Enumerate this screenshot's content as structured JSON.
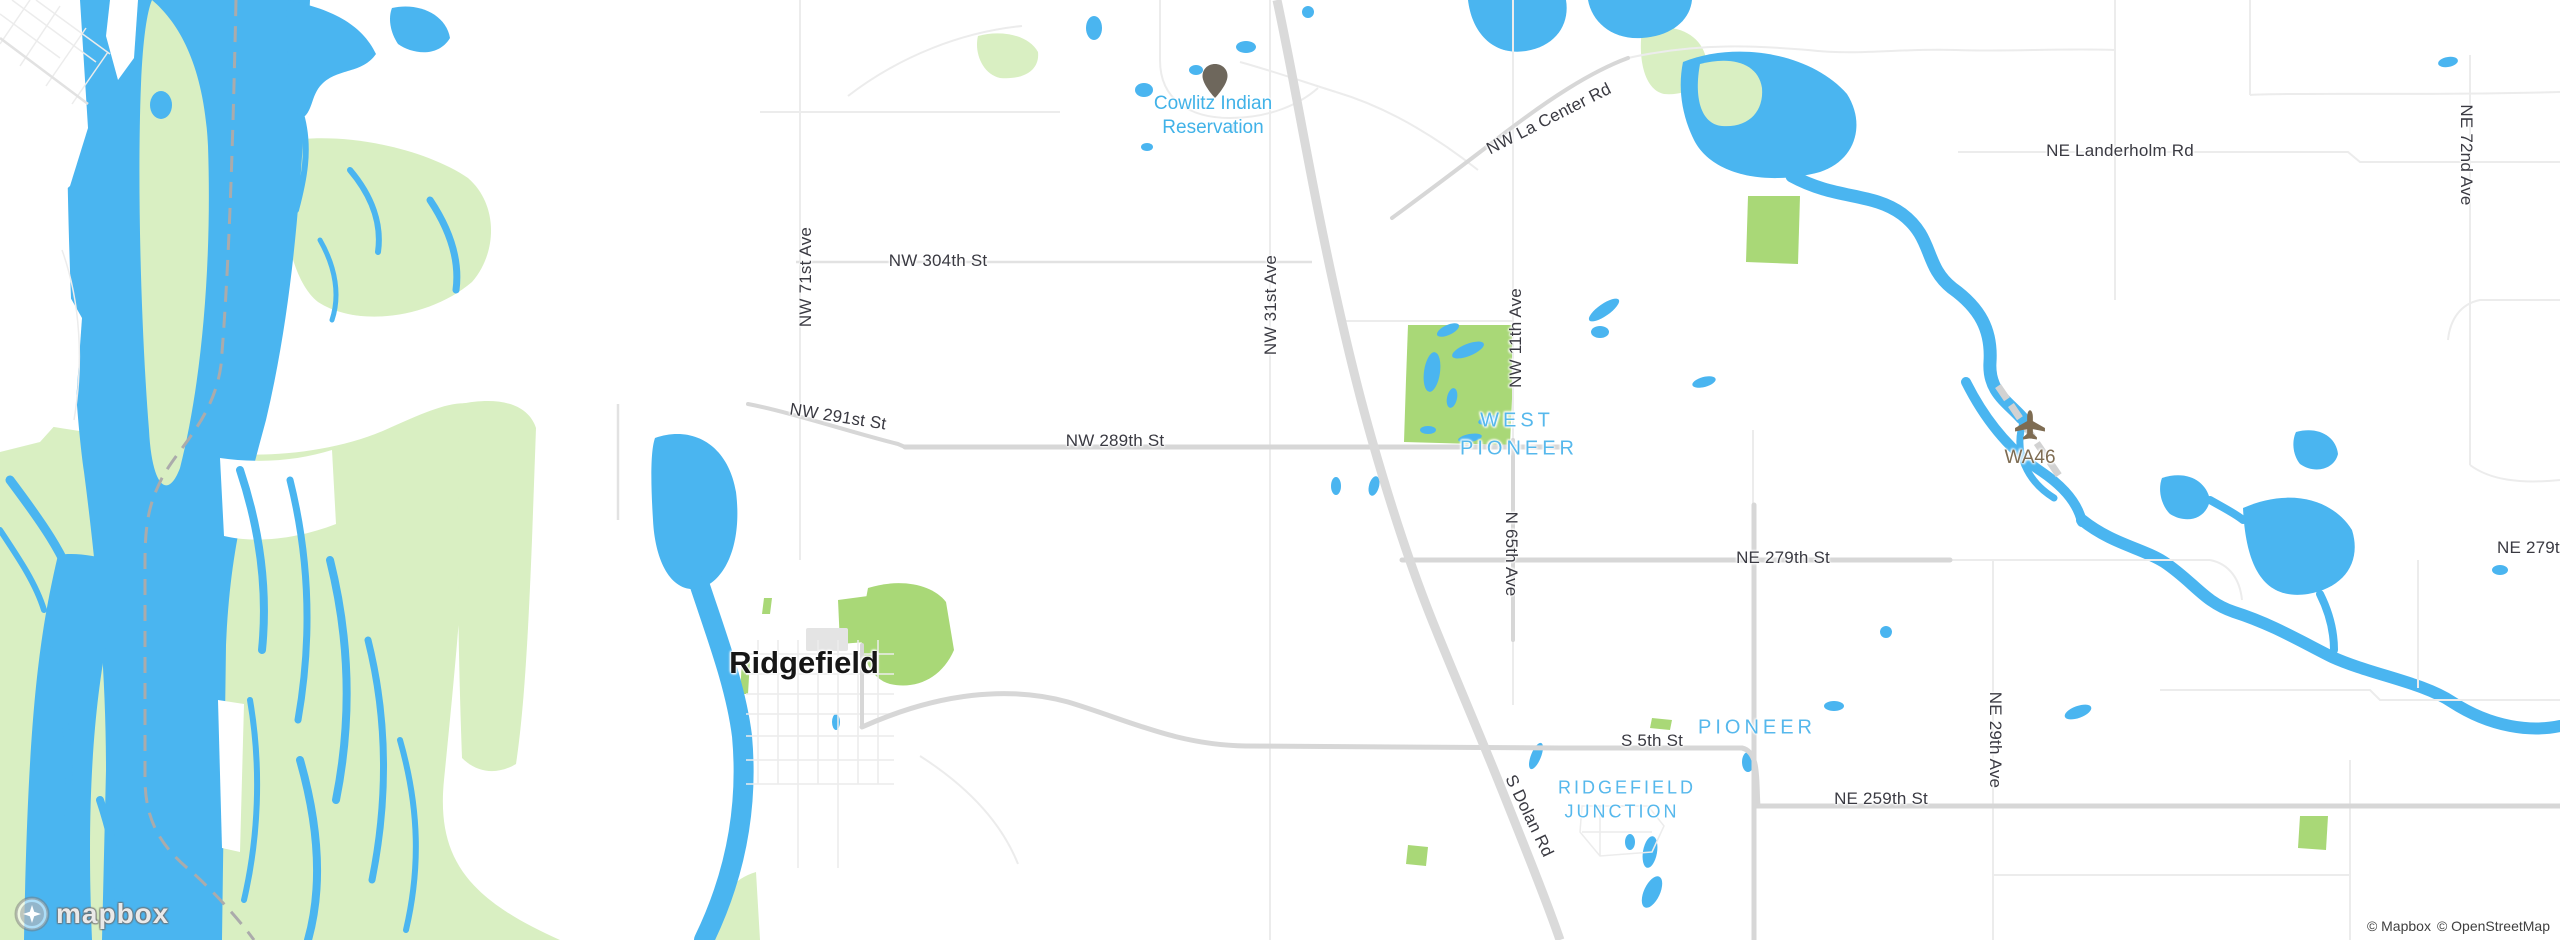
{
  "map": {
    "city_label": "Ridgefield",
    "reservation": {
      "line1": "Cowlitz Indian",
      "line2": "Reservation"
    },
    "neighborhoods": {
      "west_pioneer_line1": "WEST",
      "west_pioneer_line2": "PIONEER",
      "pioneer": "PIONEER",
      "junction_line1": "RIDGEFIELD",
      "junction_line2": "JUNCTION"
    },
    "airport_code": "WA46",
    "roads": {
      "nw_la_center_rd": "NW La Center Rd",
      "ne_landerholm_rd": "NE Landerholm Rd",
      "ne_72nd_ave": "NE 72nd Ave",
      "nw_71st_ave": "NW 71st Ave",
      "nw_304th_st": "NW 304th St",
      "nw_31st_ave": "NW 31st Ave",
      "nw_11th_ave": "NW 11th Ave",
      "nw_291st_st": "NW 291st St",
      "nw_289th_st": "NW 289th St",
      "ne_279th_st": "NE 279th St",
      "ne_279th_st_east": "NE 279th St",
      "n_65th_ave": "N 65th Ave",
      "s_5th_st": "S 5th St",
      "s_dolan_rd": "S Dolan Rd",
      "ne_259th_st": "NE 259th St",
      "ne_29th_ave": "NE 29th Ave"
    }
  },
  "branding": {
    "logo_text": "mapbox",
    "attribution_mapbox": "© Mapbox",
    "attribution_osm": "© OpenStreetMap"
  },
  "colors": {
    "land": "#ffffff",
    "water": "#4ab5f0",
    "wetland": "#d9efc2",
    "park": "#a9d877",
    "road_minor": "#ececec",
    "road_mid": "#e2e2e2",
    "road_major": "#d7d7d7",
    "highway": "#dadada",
    "rail": "#d2d2d2",
    "building": "#e4e4e4",
    "boundary": "#ababab",
    "road_label": "#3a3a42",
    "place_label": "#56b8ec",
    "reservation_label": "#41b2e8",
    "airport_label": "#7e6c52",
    "city_label": "#161616",
    "marker": "#6e675c"
  }
}
